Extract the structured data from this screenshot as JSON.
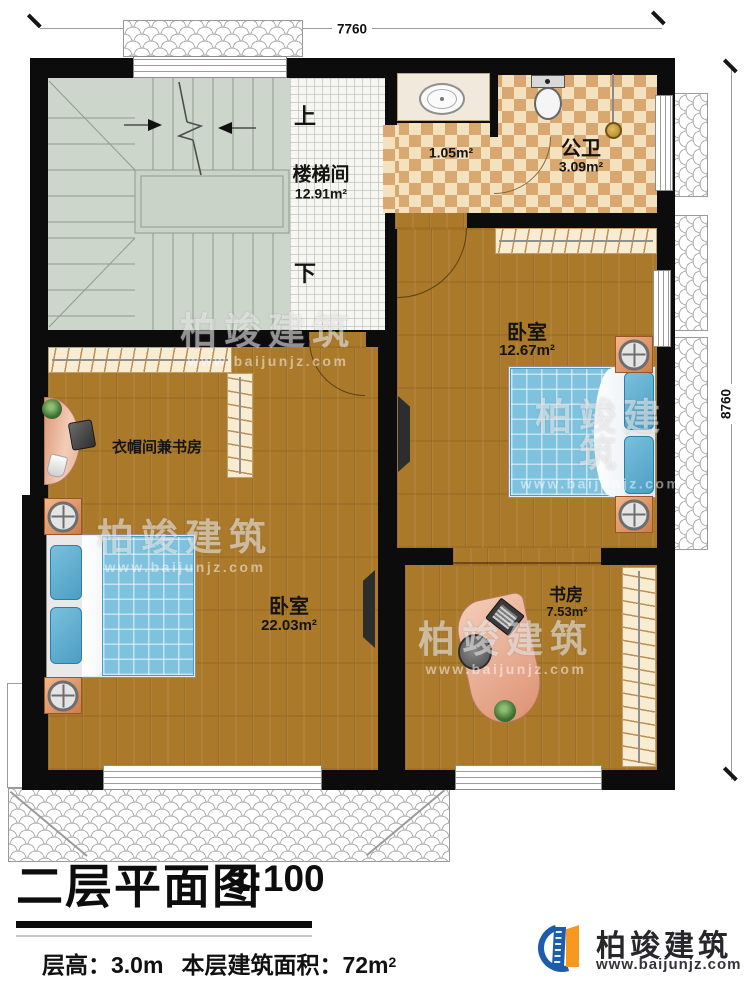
{
  "dimensions": {
    "width_label": "7760",
    "height_label": "8760"
  },
  "rooms": {
    "stairwell": {
      "name": "楼梯间",
      "area": "12.91m²",
      "up_label": "上",
      "down_label": "下"
    },
    "vestibule": {
      "area": "1.05m²"
    },
    "toilet": {
      "name": "公卫",
      "area": "3.09m²"
    },
    "bedroom_right": {
      "name": "卧室",
      "area": "12.67m²"
    },
    "cloakroom_study": {
      "name": "衣帽间兼书房"
    },
    "bedroom_left": {
      "name": "卧室",
      "area": "22.03m²"
    },
    "study": {
      "name": "书房",
      "area": "7.53m²"
    }
  },
  "title_block": {
    "title": "二层平面图",
    "scale": "1:100",
    "floor_height": "层高：3.0m",
    "floor_area": "本层建筑面积：72m",
    "floor_area_sup": "2"
  },
  "brand": {
    "name": "柏竣建筑",
    "website": "www.baijunjz.com"
  },
  "watermark": {
    "text": "柏竣建筑",
    "website": "www.baijunjz.com"
  },
  "colors": {
    "wall": "#0c0c0c",
    "wood": "#aa792a",
    "stair": "#cdd6cb",
    "checker_light": "#f3e2bd",
    "checker_dark": "#d9a871",
    "bed": "#7fc2de",
    "brand_blue": "#1d5cab",
    "brand_orange": "#f6991e"
  }
}
